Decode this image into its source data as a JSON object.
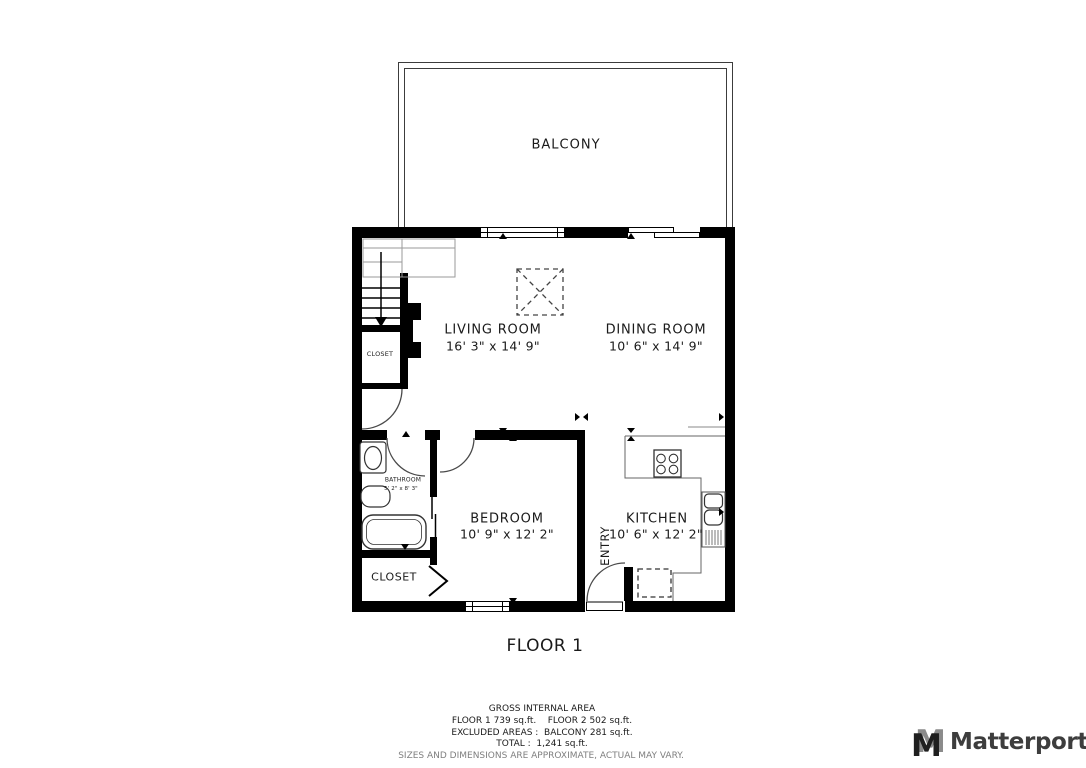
{
  "plan": {
    "balcony_label": "BALCONY",
    "floor_label": "FLOOR 1",
    "rooms": {
      "living": {
        "name": "LIVING ROOM",
        "dims": "16' 3\" x 14' 9\""
      },
      "dining": {
        "name": "DINING ROOM",
        "dims": "10' 6\" x 14' 9\""
      },
      "bedroom": {
        "name": "BEDROOM",
        "dims": "10' 9\" x 12' 2\""
      },
      "kitchen": {
        "name": "KITCHEN",
        "dims": "10' 6\" x 12' 2\""
      },
      "bathroom": {
        "name": "BATHROOM",
        "dims": "5' 2\" x 8' 3\""
      },
      "closet_upper": {
        "name": "CLOSET"
      },
      "closet_lower": {
        "name": "CLOSET"
      },
      "entry": {
        "name": "ENTRY"
      }
    }
  },
  "footer": {
    "line1": "GROSS INTERNAL AREA",
    "line2": "FLOOR 1 739 sq.ft.    FLOOR 2 502 sq.ft.",
    "line3": "EXCLUDED AREAS :  BALCONY 281 sq.ft.",
    "line4": "TOTAL :  1,241 sq.ft.",
    "disclaimer": "SIZES AND DIMENSIONS ARE APPROXIMATE, ACTUAL MAY VARY."
  },
  "branding": {
    "logo_text": "Matterport",
    "logo_icon": "matterport-m-icon"
  },
  "colors": {
    "wall": "#000000",
    "fixture_line": "#444444",
    "text": "#1a1a1a",
    "muted_text": "#7f7f7f",
    "logo_dark": "#3d3d3d",
    "logo_gray": "#8b8b8b",
    "background": "#ffffff"
  }
}
